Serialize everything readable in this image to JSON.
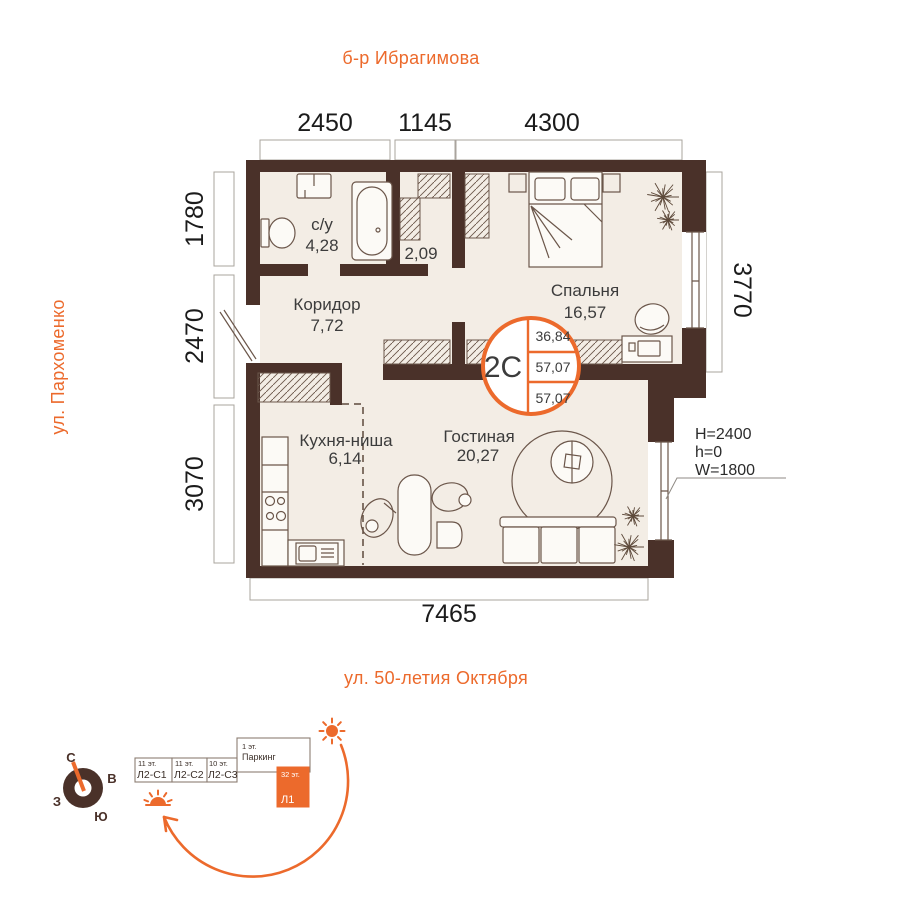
{
  "streets": {
    "top": "б-р Ибрагимова",
    "left": "ул. Пархоменко",
    "bottom": "ул. 50-летия Октября"
  },
  "dimensions": {
    "top": [
      "2450",
      "1145",
      "4300"
    ],
    "left": [
      "1780",
      "2470",
      "3070"
    ],
    "right": [
      "3770"
    ],
    "bottom": [
      "7465"
    ]
  },
  "rooms": {
    "bathroom": {
      "label": "с/у",
      "area": "4,28"
    },
    "dressing": {
      "area": "2,09"
    },
    "corridor": {
      "label": "Коридор",
      "area": "7,72"
    },
    "bedroom": {
      "label": "Спальня",
      "area": "16,57"
    },
    "kitchen": {
      "label": "Кухня-ниша",
      "area": "6,14"
    },
    "living": {
      "label": "Гостиная",
      "area": "20,27"
    }
  },
  "badge": {
    "code": "2С",
    "values": [
      "36,84",
      "57,07",
      "57,07"
    ]
  },
  "window_note": {
    "line1": "H=2400",
    "line2": "h=0",
    "line3": "W=1800"
  },
  "compass": {
    "north": "С",
    "east": "В",
    "south": "Ю",
    "west": "З"
  },
  "scheme": {
    "blocks": [
      {
        "floors": "11 эт.",
        "code": "Л2-С1"
      },
      {
        "floors": "11 эт.",
        "code": "Л2-С2"
      },
      {
        "floors": "10 эт.",
        "code": "Л2-С3"
      }
    ],
    "parking": {
      "floors": "1 эт.",
      "name": "Паркинг"
    },
    "tower": {
      "floors": "32 эт.",
      "code": "Л1"
    }
  },
  "colors": {
    "wall": "#4a3129",
    "floor": "#f3ede5",
    "accent": "#ec6a2c",
    "line": "#6b564a"
  }
}
